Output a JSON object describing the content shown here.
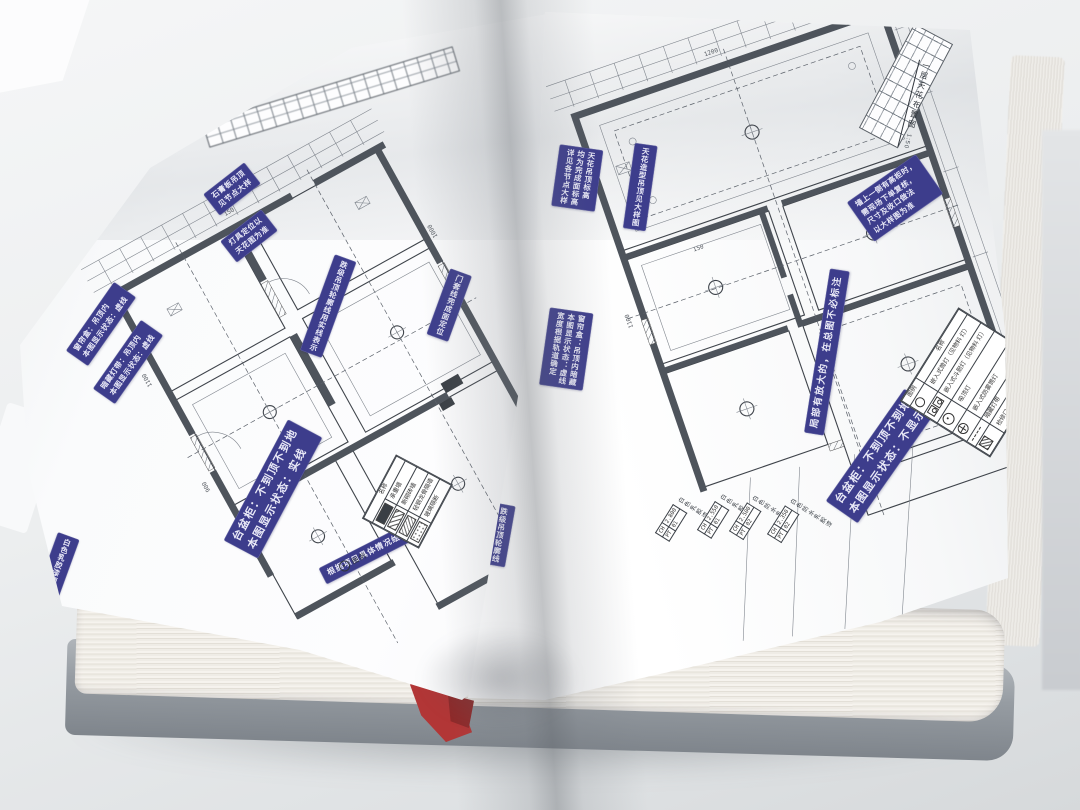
{
  "colors": {
    "label_bg": "#3d3d8c",
    "label_text": "#e9e9f7",
    "bookmark": "#b23636",
    "paper": "#fdfdfe",
    "wall_fill": "#4e545c",
    "line": "#3f444b"
  },
  "left_page": {
    "labels": [
      {
        "text": "台盆柜：不到顶不到地\n本图显示状态：实线"
      },
      {
        "text": "根据项目具体情况绘制"
      },
      {
        "text": "暗藏灯带：吊顶内\n本图显示状态：虚线"
      },
      {
        "text": "窗帘盒：吊顶内\n本图显示状态：虚线"
      },
      {
        "text": "石膏板吊顶\n见节点大样"
      },
      {
        "text": "灯具定位以\n天花图为准"
      },
      {
        "text": "跌级吊顶轮廓线用实线表示"
      },
      {
        "text": "门套线完成面定位"
      },
      {
        "text": "白色乳胶漆顶面"
      }
    ],
    "legend": {
      "title": "图例",
      "header": "名称",
      "rows": [
        {
          "name": "承重墙"
        },
        {
          "name": "新砌砖墙"
        },
        {
          "name": "轻钢龙骨隔墙"
        },
        {
          "name": "玻璃隔断"
        }
      ]
    },
    "dims": [
      "150",
      "1100",
      "900",
      "1000"
    ]
  },
  "right_page": {
    "labels": [
      {
        "text": "台盆柜：不到顶不到地\n本图显示状态：不显示"
      },
      {
        "text": "局部有放大的，在总图不必标注"
      },
      {
        "text": "墙上一侧有高柜时，\n需现场下单复核，\n尺寸及收口做法\n以大样图为准"
      },
      {
        "text": "天花吊顶标高\n均为完成面标高\n详见各节点大样"
      },
      {
        "text": "天花造型吊顶见大样图"
      },
      {
        "text": "窗帘盒：吊顶内暗藏\n本图显示状态：虚线\n宽度根据轨道确定"
      },
      {
        "text": "跌级吊顶轮廓线\n用粗实线表示"
      }
    ],
    "ceiling_tags": [
      {
        "ch_label": "CH",
        "ch": "2.800",
        "pt_label": "PT",
        "pt": "01",
        "finish": "白色乳胶漆"
      },
      {
        "ch_label": "CH",
        "ch": "2.550",
        "pt_label": "PT",
        "pt": "01",
        "finish": "白色乳胶漆"
      },
      {
        "ch_label": "CH",
        "ch": "2.500",
        "pt_label": "PT",
        "pt": "02",
        "finish": "白色防水乳胶漆"
      },
      {
        "ch_label": "CH",
        "ch": "2.350",
        "pt_label": "PT",
        "pt": "02",
        "finish": "白色防水乳胶漆"
      }
    ],
    "legend": {
      "col_name": "名称",
      "col_symbol": "图例",
      "rows": [
        {
          "name": "嵌入式筒灯（见物料 灯）"
        },
        {
          "name": "嵌入式斗胆灯（见物料 灯）"
        },
        {
          "name": "吸顶灯"
        },
        {
          "name": "嵌入式防雾筒灯"
        },
        {
          "name": "暗藏灯带"
        },
        {
          "name": "检修口"
        }
      ]
    },
    "title": {
      "text": "一层天花布置图",
      "scale": "1:50"
    },
    "dims": [
      "1200",
      "600",
      "1100",
      "150"
    ]
  }
}
